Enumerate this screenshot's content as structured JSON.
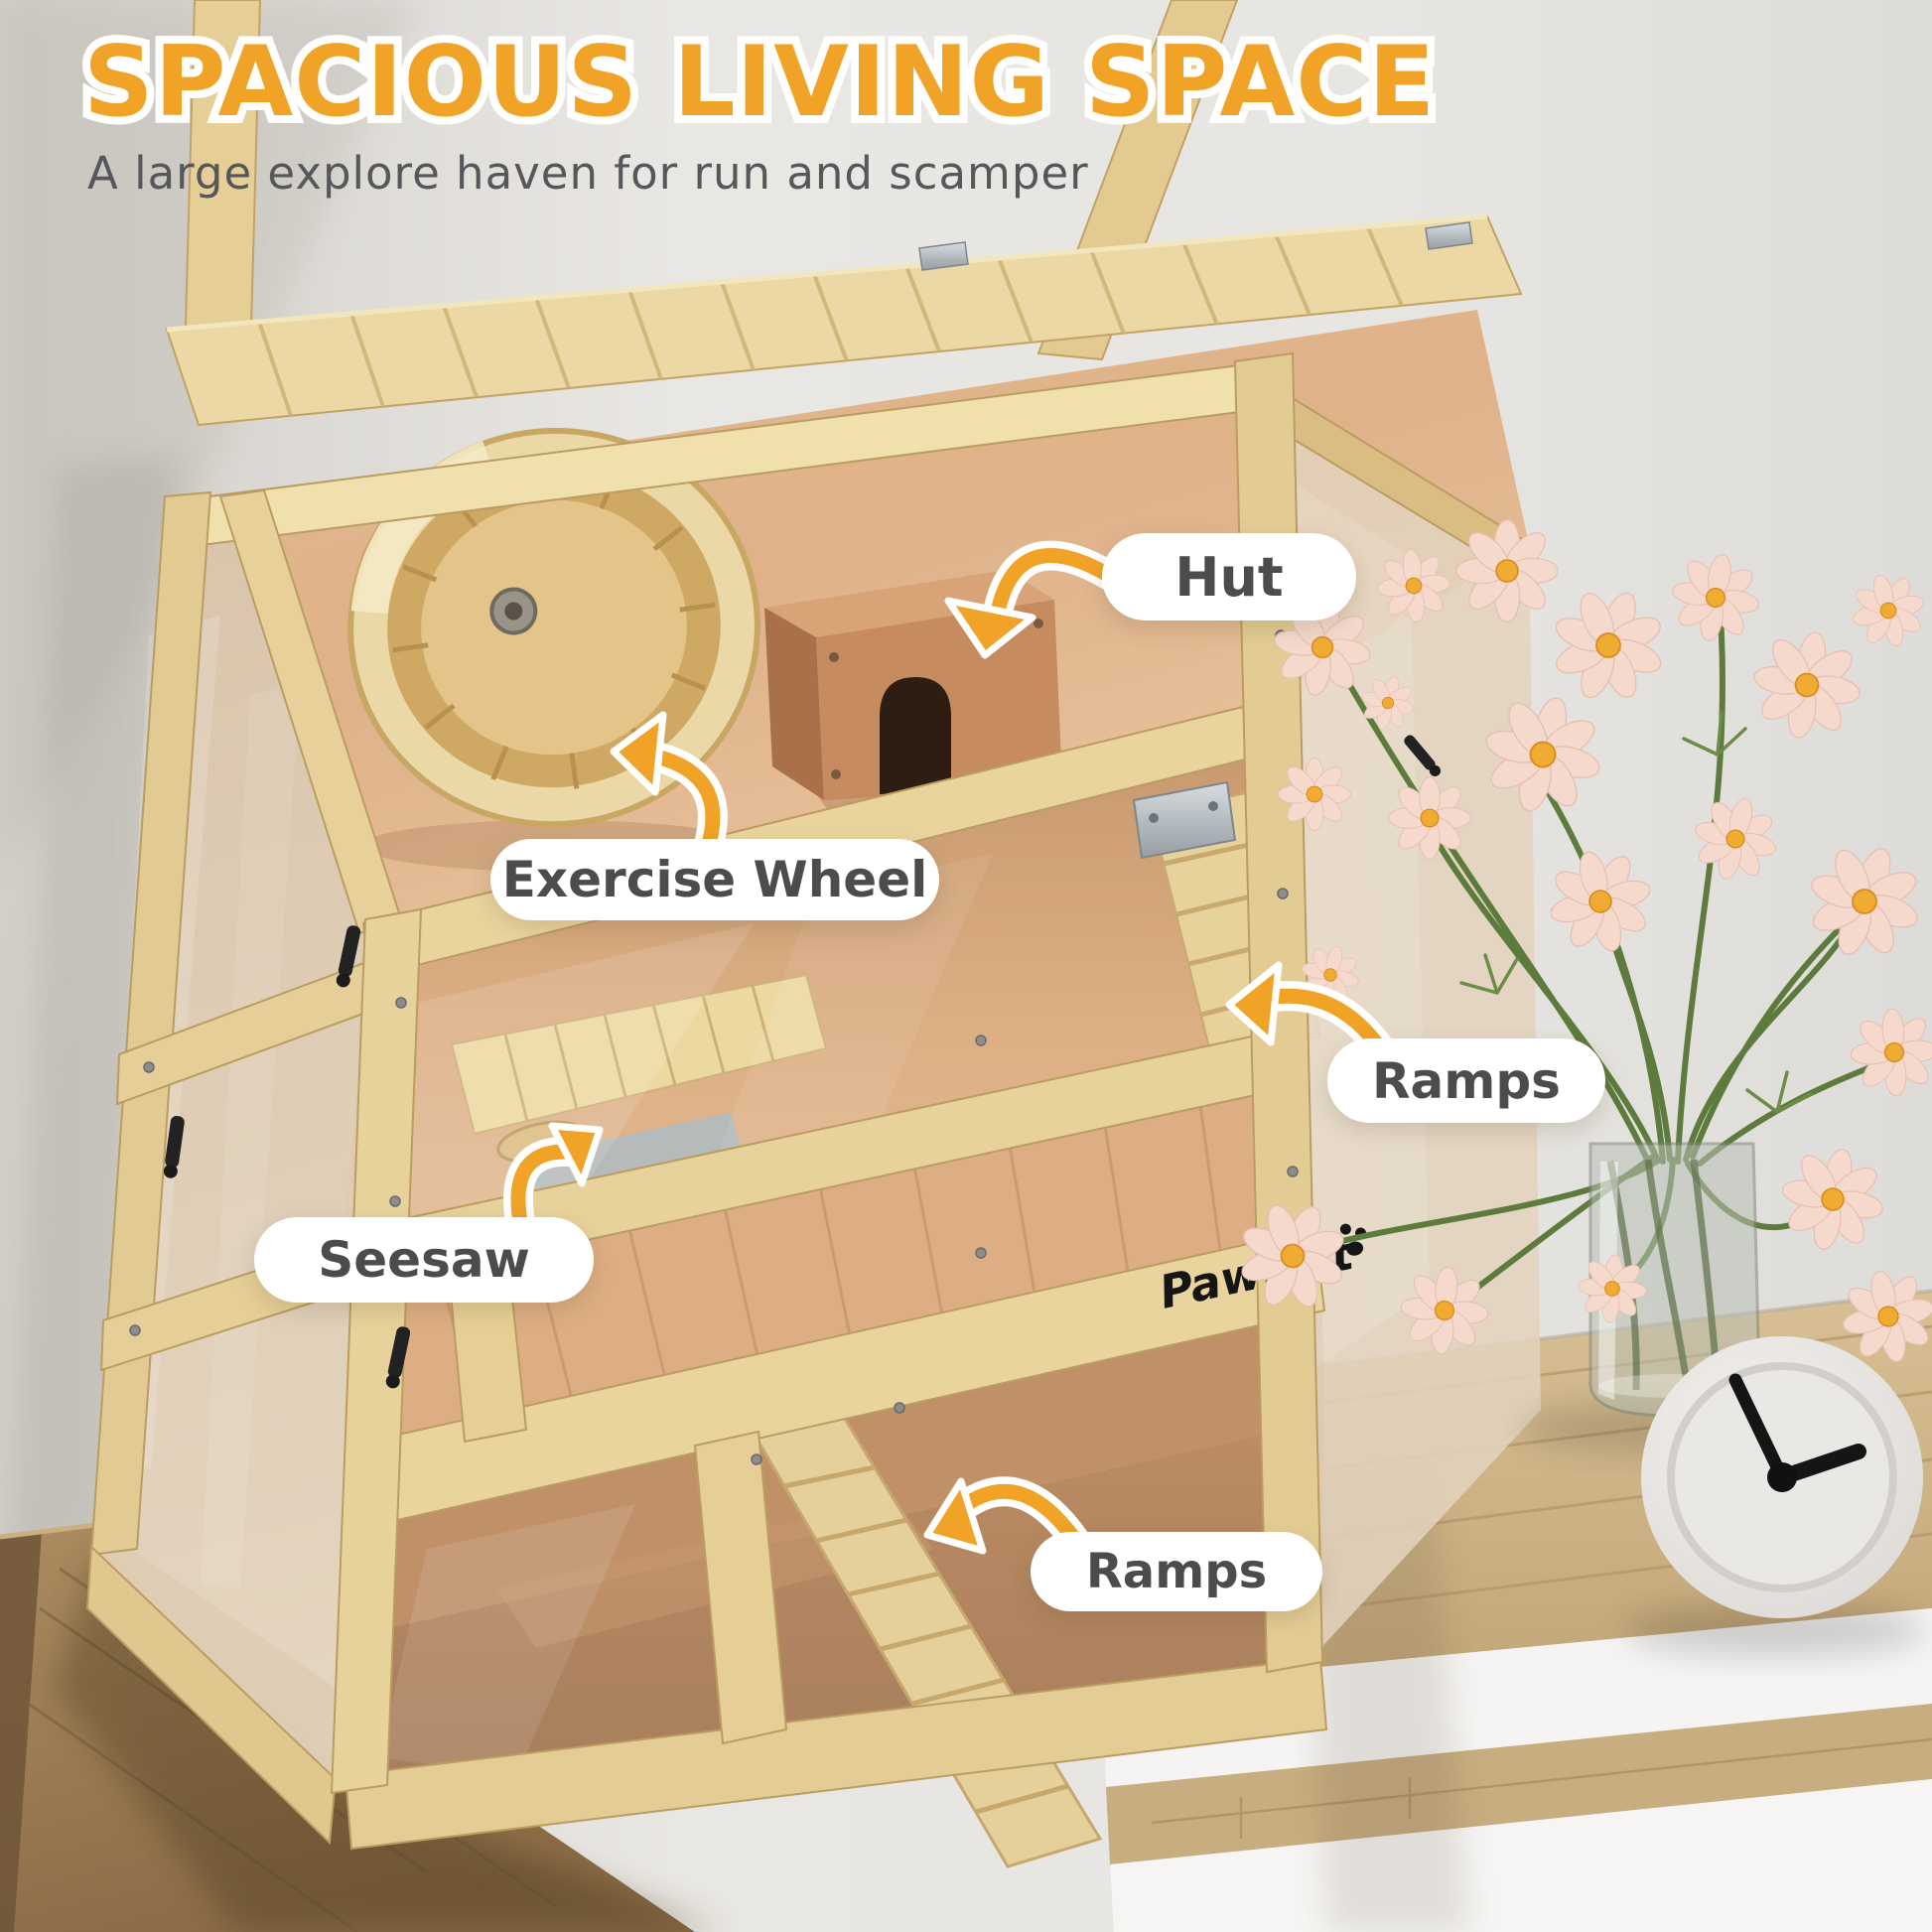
{
  "header": {
    "title": "SPACIOUS LIVING SPACE",
    "subtitle": "A large explore haven for run and scamper"
  },
  "callouts": [
    {
      "id": "hut",
      "label": "Hut"
    },
    {
      "id": "exercise-wheel",
      "label": "Exercise Wheel"
    },
    {
      "id": "ramps-upper",
      "label": "Ramps"
    },
    {
      "id": "seesaw",
      "label": "Seesaw"
    },
    {
      "id": "ramps-lower",
      "label": "Ramps"
    }
  ],
  "brand": {
    "logo_text": "PawHut"
  },
  "colors": {
    "accent_orange": "#F0A327",
    "title_outline": "#FFFFFF",
    "subtitle_text": "#56575A",
    "label_text": "#4C4C4E",
    "pill_background": "#FFFFFF",
    "pine_wood": "#E8D29B",
    "interior_wood": "#D9A87D",
    "wall": "#E6E4E0"
  }
}
